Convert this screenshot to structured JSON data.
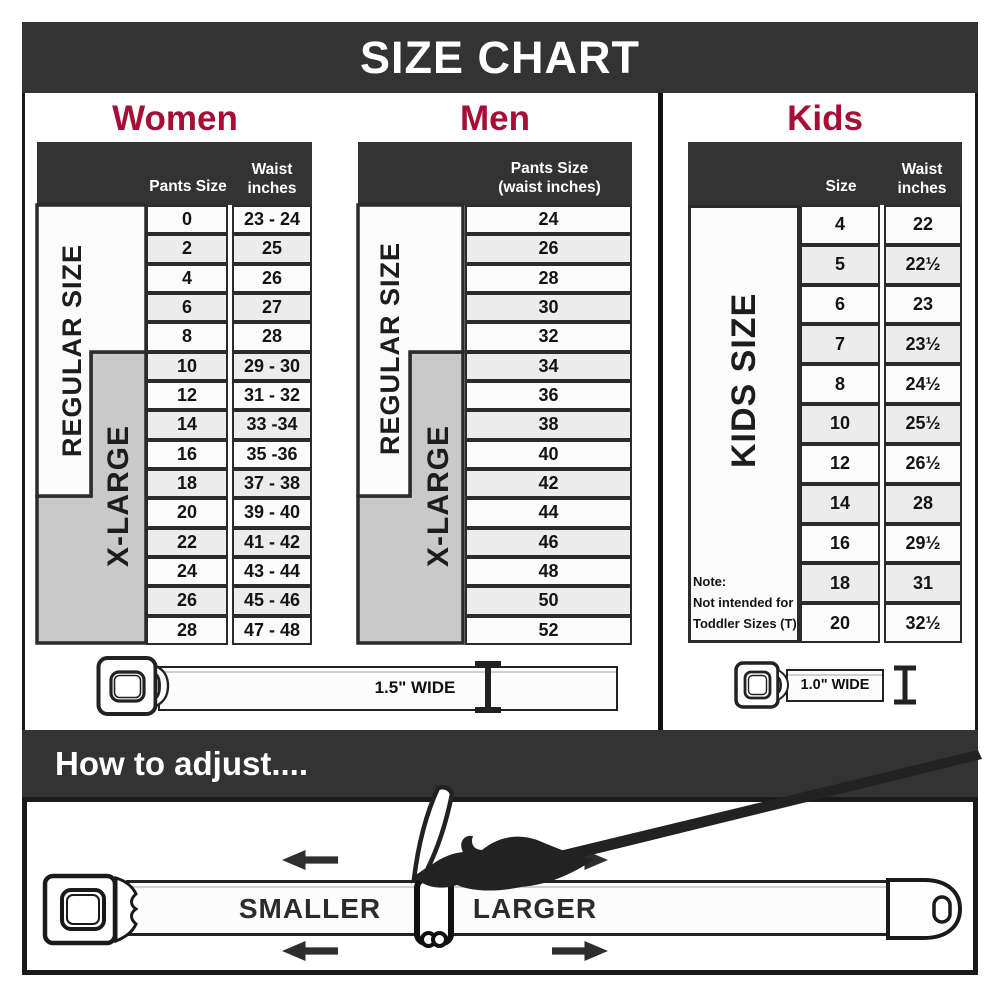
{
  "title_bar": {
    "title": "SIZE CHART"
  },
  "women": {
    "heading": "Women",
    "pants_header": "Pants Size",
    "waist_header": "Waist inches",
    "regular_label": "REGULAR SIZE",
    "xlarge_label": "X-LARGE"
  },
  "men": {
    "heading": "Men",
    "header_line1": "Pants Size",
    "header_line2": "(waist inches)",
    "regular_label": "REGULAR SIZE",
    "xlarge_label": "X-LARGE"
  },
  "kids": {
    "heading": "Kids",
    "size_header": "Size",
    "waist_header": "Waist inches",
    "side_label": "KIDS SIZE",
    "note_line1": "Note:",
    "note_line2": "Not intended for",
    "note_line3": "Toddler Sizes (T)"
  },
  "belts": {
    "adult_width_label": "1.5\" WIDE",
    "kids_width_label": "1.0\" WIDE"
  },
  "adjust": {
    "heading": "How to adjust....",
    "smaller_label": "SMALLER",
    "larger_label": "LARGER"
  },
  "colors": {
    "accent": "#A60E36",
    "bar_dark": "#333333",
    "row_alt": "#ECECEC",
    "panel_gray": "#C9C9C9"
  },
  "chart_data": [
    {
      "type": "table",
      "title": "Women",
      "columns": [
        "Pants Size",
        "Waist inches"
      ],
      "rows": [
        [
          "0",
          "23 - 24"
        ],
        [
          "2",
          "25"
        ],
        [
          "4",
          "26"
        ],
        [
          "6",
          "27"
        ],
        [
          "8",
          "28"
        ],
        [
          "10",
          "29 - 30"
        ],
        [
          "12",
          "31 - 32"
        ],
        [
          "14",
          "33 -34"
        ],
        [
          "16",
          "35 -36"
        ],
        [
          "18",
          "37 - 38"
        ],
        [
          "20",
          "39 - 40"
        ],
        [
          "22",
          "41 - 42"
        ],
        [
          "24",
          "43 - 44"
        ],
        [
          "26",
          "45 - 46"
        ],
        [
          "28",
          "47 - 48"
        ]
      ],
      "row_groups": [
        {
          "label": "REGULAR SIZE",
          "pants_sizes": "0-18"
        },
        {
          "label": "X-LARGE",
          "pants_sizes": "10-28"
        }
      ]
    },
    {
      "type": "table",
      "title": "Men",
      "columns": [
        "Pants Size (waist inches)"
      ],
      "rows": [
        [
          "24"
        ],
        [
          "26"
        ],
        [
          "28"
        ],
        [
          "30"
        ],
        [
          "32"
        ],
        [
          "34"
        ],
        [
          "36"
        ],
        [
          "38"
        ],
        [
          "40"
        ],
        [
          "42"
        ],
        [
          "44"
        ],
        [
          "46"
        ],
        [
          "48"
        ],
        [
          "50"
        ],
        [
          "52"
        ]
      ],
      "row_groups": [
        {
          "label": "REGULAR SIZE",
          "pants_sizes": "24-32"
        },
        {
          "label": "X-LARGE",
          "pants_sizes": "34-52"
        }
      ]
    },
    {
      "type": "table",
      "title": "Kids",
      "columns": [
        "Size",
        "Waist inches"
      ],
      "rows": [
        [
          "4",
          "22"
        ],
        [
          "5",
          "22½"
        ],
        [
          "6",
          "23"
        ],
        [
          "7",
          "23½"
        ],
        [
          "8",
          "24½"
        ],
        [
          "10",
          "25½"
        ],
        [
          "12",
          "26½"
        ],
        [
          "14",
          "28"
        ],
        [
          "16",
          "29½"
        ],
        [
          "18",
          "31"
        ],
        [
          "20",
          "32½"
        ]
      ],
      "note": "Note: Not intended for Toddler Sizes (T)"
    }
  ]
}
